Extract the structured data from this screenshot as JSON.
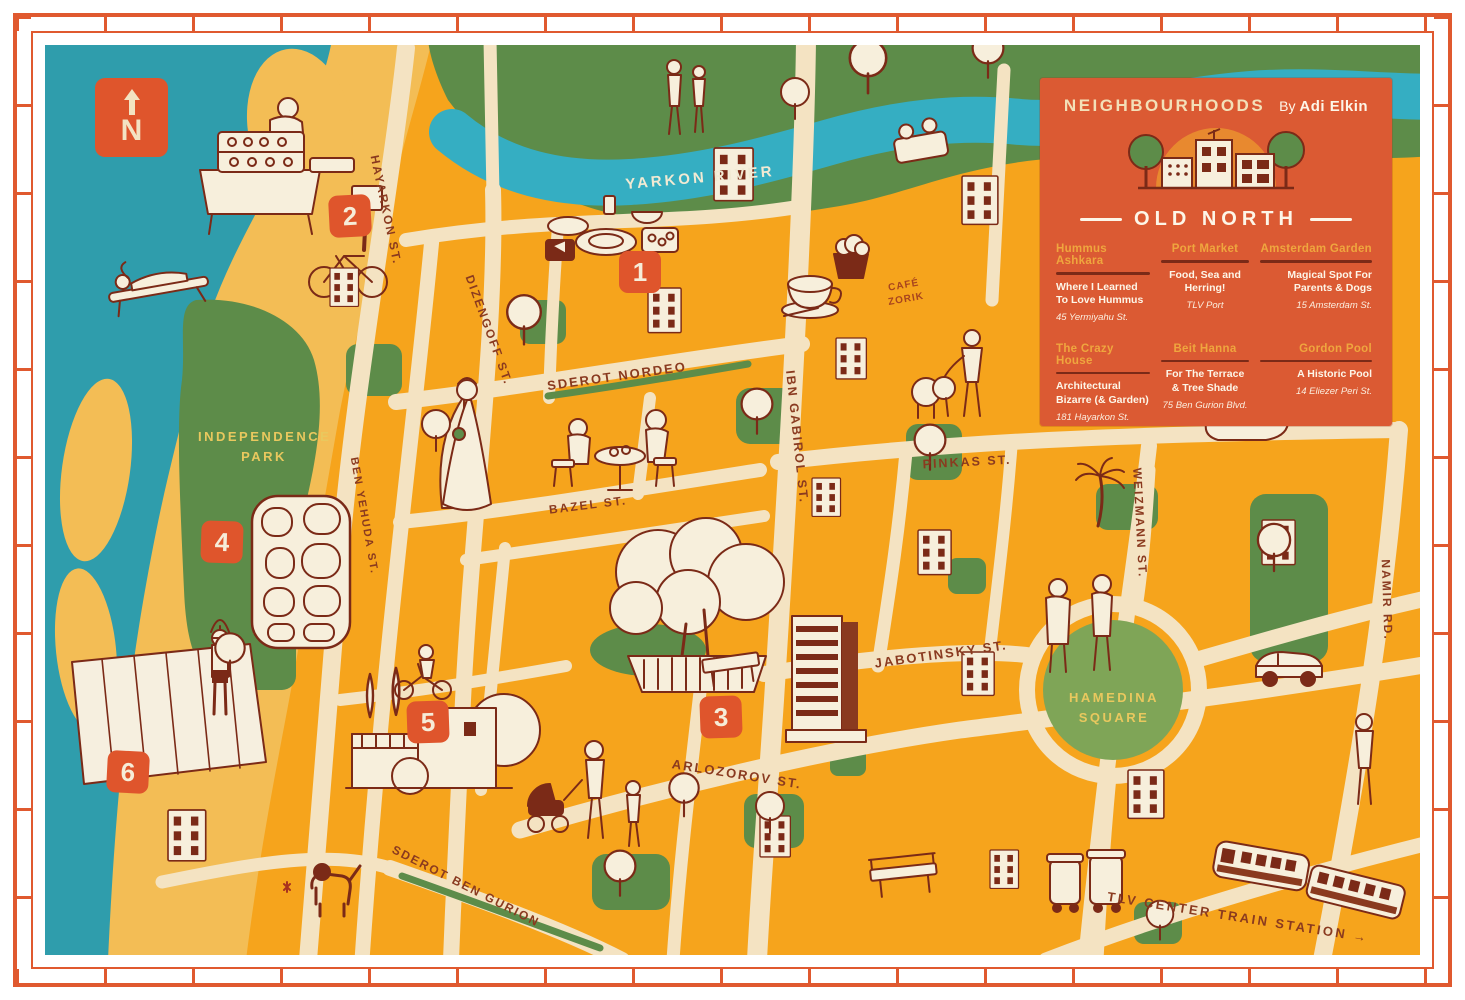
{
  "panel": {
    "series_title": "NEIGHBOURHOODS",
    "byline_prefix": "By",
    "author": "Adi Elkin",
    "neighbourhood": "OLD NORTH",
    "entries": [
      {
        "num": "1",
        "name": "Hummus Ashkara",
        "desc": "Where I Learned To Love Hummus",
        "address": "45 Yermiyahu St."
      },
      {
        "num": "2",
        "name": "Port Market",
        "desc": "Food, Sea and Herring!",
        "address": "TLV Port"
      },
      {
        "num": "3",
        "name": "Amsterdam Garden",
        "desc": "Magical Spot For Parents & Dogs",
        "address": "15 Amsterdam St."
      },
      {
        "num": "4",
        "name": "The Crazy House",
        "desc": "Architectural Bizarre (& Garden)",
        "address": "181 Hayarkon St."
      },
      {
        "num": "5",
        "name": "Beit Hanna",
        "desc": "For The Terrace & Tree Shade",
        "address": "75 Ben Gurion Blvd."
      },
      {
        "num": "6",
        "name": "Gordon Pool",
        "desc": "A Historic Pool",
        "address": "14 Eliezer Peri St."
      }
    ]
  },
  "compass": {
    "letter": "N"
  },
  "map": {
    "labels": {
      "yarkon_river": "YARKON RIVER",
      "hayarkon_st": "HAYARKON ST.",
      "ben_yehuda_st": "BEN YEHUDA ST.",
      "dizengoff_st": "DIZENGOFF ST.",
      "sderot_nordeo": "SDEROT NORDEO",
      "ibn_gabirol_st": "IBN GABIROL ST.",
      "bazel_st": "BAZEL ST.",
      "pinkas_st": "PINKAS ST.",
      "weizmann_st": "WEIZMANN ST.",
      "jabotinsky_st": "JABOTINSKY ST.",
      "namir_rd": "NAMIR RD.",
      "arlozorov_st": "ARLOZOROV ST.",
      "sderot_ben_gurion": "SDEROT BEN GURION",
      "tlv_train_station": "TLV CENTER TRAIN STATION →",
      "independence_park": "INDEPENDENCE PARK",
      "hamedina_square": "HAMEDINA SQUARE",
      "cafe_zorik": "CAFÉ ZORIK"
    }
  },
  "colors": {
    "sea": "#2f9dac",
    "river": "#35aec2",
    "sand": "#f3bd55",
    "map_base": "#f6a41c",
    "park": "#5d8c49",
    "road": "#f4e3c2",
    "panel": "#db5a33",
    "marker": "#df552c",
    "ink": "#7b2a17",
    "accent_yellow": "#efa63e",
    "street_label": "#8a3a1f"
  }
}
